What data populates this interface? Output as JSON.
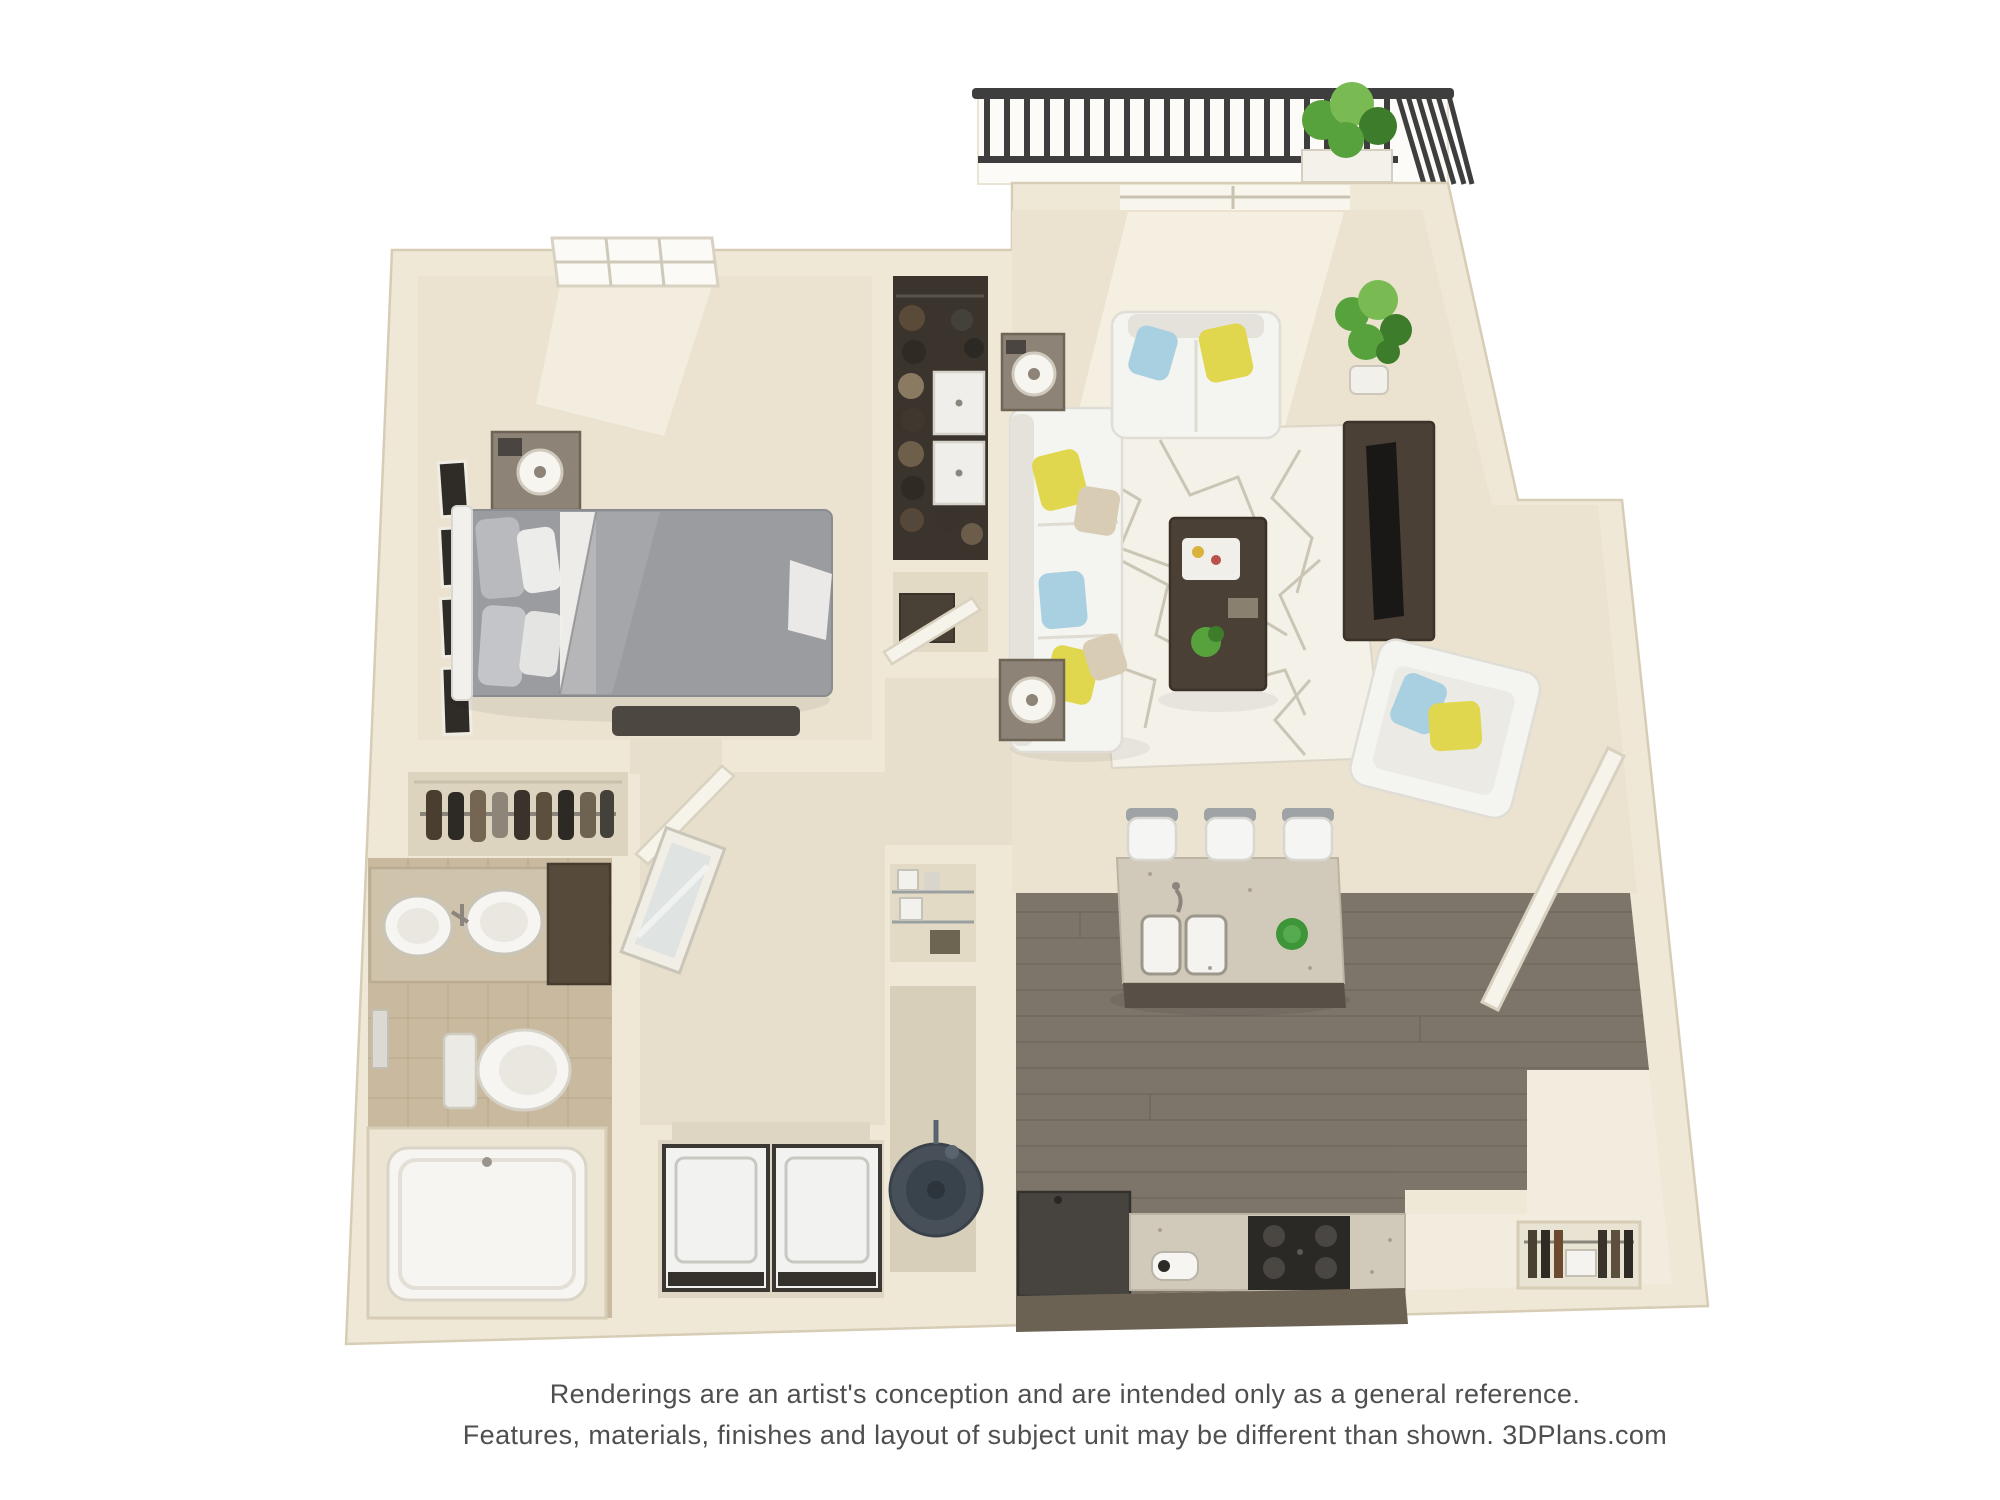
{
  "disclaimer": {
    "line1": "Renderings are an artist's conception and are intended only as a general reference.",
    "line2": "Features, materials, finishes and layout of subject unit may be different than shown. 3DPlans.com"
  },
  "plan": {
    "type": "3d-top-down-floor-plan-rendering",
    "rooms": [
      "balcony",
      "living-room",
      "dining-area",
      "kitchen",
      "entry",
      "bedroom",
      "walk-in-closet",
      "linen-closet",
      "hallway",
      "bathroom",
      "laundry-closet",
      "utility-closet",
      "pantry-niche",
      "coat-closet"
    ],
    "furniture": [
      "balcony-railing",
      "balcony-bistro-chair",
      "balcony-plant",
      "sliding-glass-door",
      "loveseat",
      "sofa",
      "end-table-lamps",
      "area-rug",
      "coffee-table",
      "tv-console",
      "accent-chair",
      "potted-plant",
      "queen-bed",
      "foot-bench",
      "nightstand-lamp",
      "wall-art-frames",
      "bedroom-window",
      "closet-hanging-clothes",
      "closet-drawers",
      "vanity-sinks",
      "toilet",
      "bathtub",
      "leaning-mirror",
      "washer",
      "dryer",
      "water-heater",
      "wire-shelves",
      "kitchen-island-sink",
      "bar-stools",
      "range-stove",
      "refrigerator",
      "entry-door",
      "coat-closet-shelves"
    ]
  },
  "colors": {
    "pageBg": "#ffffff",
    "textColor": "#4f4f4f",
    "wall": "#efe8d6",
    "wallLine": "#d7cdb6",
    "floor": "#ebe3d0",
    "floorDark": "#e3dac5",
    "hallFloor": "#e7dfcb",
    "bathFloor": "#c9b99e",
    "bathLine": "#b2a184",
    "closetDark": "#3b342c",
    "kitchenFloor": "#7d756a",
    "plankLine": "#675f55",
    "counterFront": "#6b6254",
    "granite": "#d1cabb",
    "graniteDot": "#a9a090",
    "stove": "#2b2926",
    "fridge": "#474440",
    "entryFloor": "#f2ecdf",
    "laundryFloor": "#ded6c2",
    "railing": "#3e3e3e",
    "sofa": "#f4f4f0",
    "sofaShade": "#e4e2da",
    "pillowYellow": "#e0d74e",
    "pillowBlue": "#a8d0e0",
    "pillowTan": "#d8ccb4",
    "rug": "#f4f1e9",
    "rugLine": "#c7c0af",
    "woodDark": "#4b4036",
    "tableWood": "#8d8376",
    "bedGray": "#9b9c9f",
    "bedGrayDark": "#85868a",
    "bedWhite": "#f1f0ec",
    "bench": "#4d4741",
    "plantGreen": "#58a23e",
    "plantGreenDark": "#3d7c2b",
    "plantGreenLight": "#79bb52",
    "waterHeater": "#475059",
    "white": "#f7f6f2",
    "doorPanel": "#f6f3ea",
    "frameDark": "#2f2b26"
  }
}
